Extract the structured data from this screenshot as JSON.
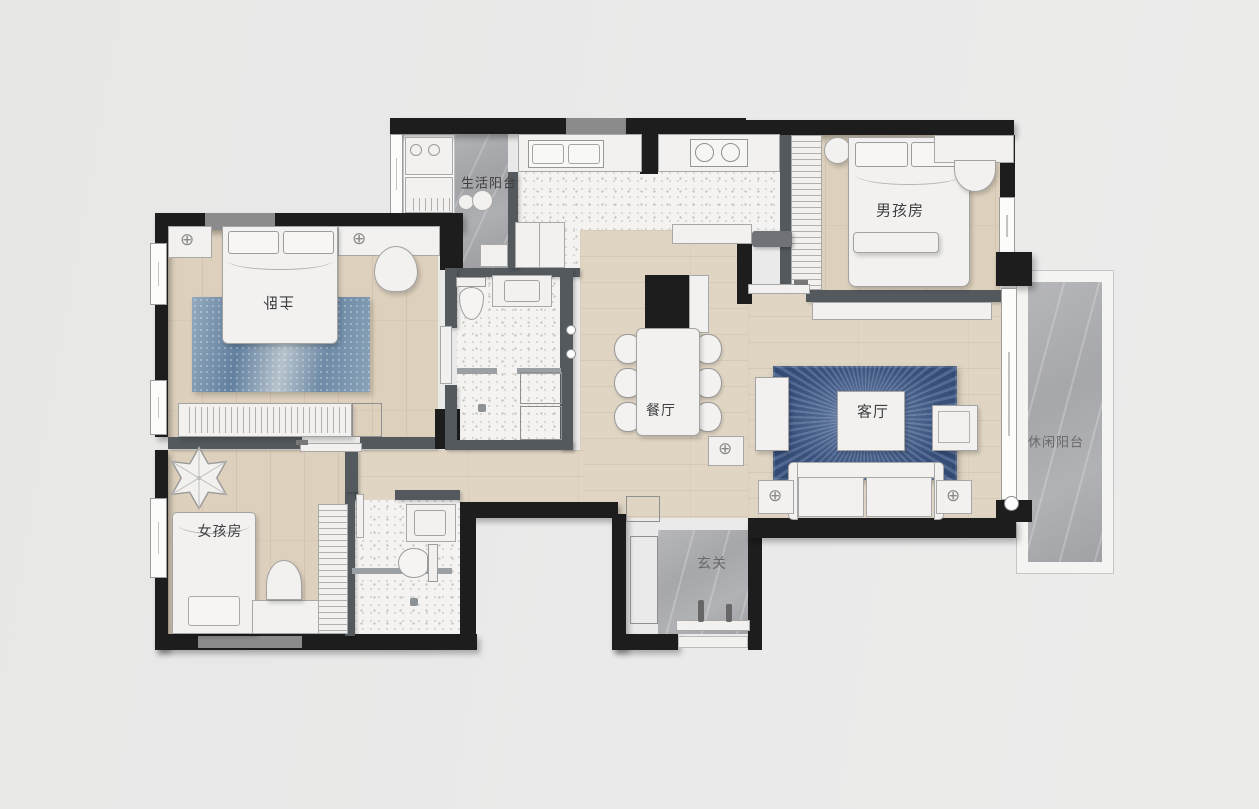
{
  "plan": {
    "rooms": {
      "utility_balcony": {
        "label": "生活阳台"
      },
      "boys_room": {
        "label": "男孩房"
      },
      "master_bedroom": {
        "label": "主卧"
      },
      "dining_room": {
        "label": "餐厅"
      },
      "living_room": {
        "label": "客厅"
      },
      "leisure_balcony": {
        "label": "休闲阳台"
      },
      "girls_room": {
        "label": "女孩房"
      },
      "foyer": {
        "label": "玄关"
      }
    },
    "palette": {
      "background": "#e9e9e9",
      "wall": "#1d1d1d",
      "partition_wall": "#54595d",
      "window_block": "#8b8b8b",
      "wood_floor": "#ddd0bc",
      "terrazzo_floor": "#f4f3f1",
      "marble_floor": "#a8a9ac",
      "furniture": "#f2f1ef",
      "rug_master": "#7792ab",
      "rug_living": "#3d5781",
      "label_text": "#3e3e40"
    }
  }
}
